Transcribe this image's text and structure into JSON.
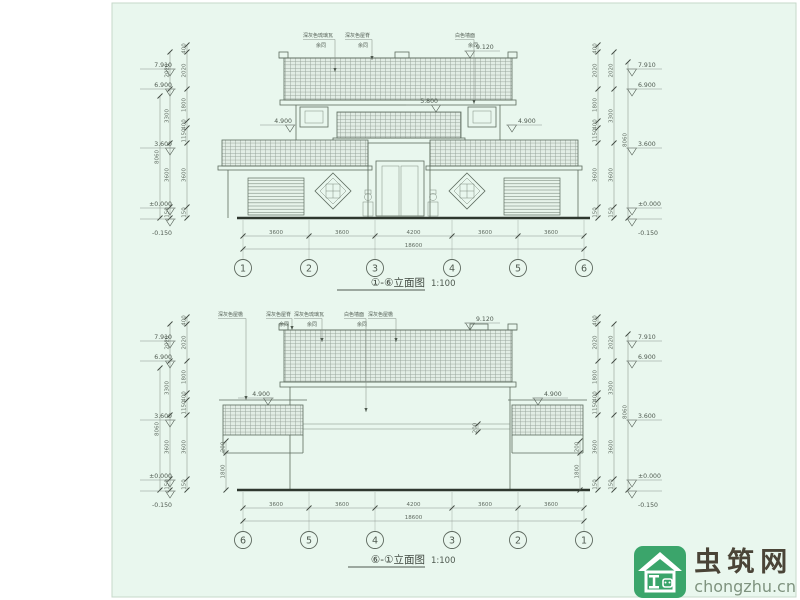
{
  "top_drawing": {
    "title": "①-⑥立面图",
    "scale_label": "1:100",
    "grid_labels": [
      "1",
      "2",
      "3",
      "4",
      "5",
      "6"
    ],
    "dims": [
      "3600",
      "3600",
      "4200",
      "3600",
      "3600"
    ],
    "dim_total": "18600",
    "height_dims_inner": [
      "400",
      "2020",
      "1800",
      "400",
      "1150",
      "3600",
      "150"
    ],
    "height_dims_outer": [
      "2020",
      "3300",
      "3600",
      "150"
    ],
    "height_total": "8060",
    "elevations": {
      "left": [
        "7.910",
        "6.900",
        "3.600",
        "±0.000",
        "-0.150"
      ],
      "right": [
        "7.910",
        "6.900",
        "3.600",
        "±0.000",
        "-0.150"
      ],
      "ridge": "9.120",
      "canopy": "5.800",
      "side_left": "4.900",
      "side_right": "4.900"
    },
    "notes": [
      {
        "label": "深灰色琉璃瓦",
        "sub": "余同"
      },
      {
        "label": "深灰色屋脊",
        "sub": "余同"
      },
      {
        "label": "白色墙面",
        "sub": "余同"
      }
    ]
  },
  "bottom_drawing": {
    "title": "⑥-①立面图",
    "scale_label": "1:100",
    "grid_labels": [
      "6",
      "5",
      "4",
      "3",
      "2",
      "1"
    ],
    "dims": [
      "3600",
      "3600",
      "4200",
      "3600",
      "3600"
    ],
    "dim_total": "18600",
    "height_dims_inner": [
      "400",
      "2020",
      "1800",
      "400",
      "1150",
      "3600",
      "150"
    ],
    "height_dims_outer": [
      "2020",
      "3300",
      "3600",
      "150"
    ],
    "height_total": "8060",
    "band_dim": "200",
    "wing_dims": [
      "200",
      "1800"
    ],
    "elevations": {
      "left": [
        "7.910",
        "6.900",
        "3.600",
        "±0.000",
        "-0.150"
      ],
      "right": [
        "7.910",
        "6.900",
        "3.600",
        "±0.000",
        "-0.150"
      ],
      "ridge": "9.120",
      "side_left": "4.900",
      "side_right": "4.900"
    },
    "notes": [
      {
        "label": "深灰色屋檐",
        "sub": ""
      },
      {
        "label": "深灰色屋脊",
        "sub": "余同"
      },
      {
        "label": "深灰色琉璃瓦",
        "sub": "余同"
      },
      {
        "label": "白色墙面",
        "sub": "余同"
      },
      {
        "label": "深灰色屋檐",
        "sub": ""
      }
    ]
  },
  "watermark": {
    "site_name": "虫筑网",
    "site_url": "chongzhu.cn"
  }
}
